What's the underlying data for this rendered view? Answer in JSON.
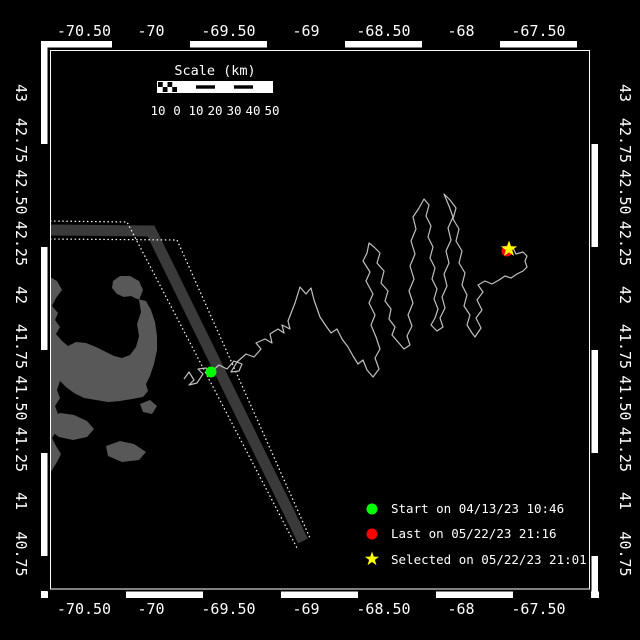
{
  "colors": {
    "background": "#000000",
    "land": "#585858",
    "track": "#c0c0c0",
    "lane_zone": "#3a3a3a",
    "frame": "#ffffff",
    "start_marker": "#00ff00",
    "last_marker": "#ff0000",
    "selected_marker": "#ffff00"
  },
  "axes": {
    "lon_labels": [
      "-70.50",
      "-70",
      "-69.50",
      "-69",
      "-68.50",
      "-68",
      "-67.50"
    ],
    "lat_labels": [
      "43",
      "42.75",
      "42.50",
      "42.25",
      "42",
      "41.75",
      "41.50",
      "41.25",
      "41",
      "40.75"
    ]
  },
  "scale_bar": {
    "title": "Scale (km)",
    "labels": [
      "10",
      "0",
      "10",
      "20",
      "30",
      "40",
      "50"
    ]
  },
  "legend": {
    "items": [
      {
        "marker": "green-circle",
        "label": "Start on 04/13/23 10:46"
      },
      {
        "marker": "red-circle",
        "label": "Last on 05/22/23 21:16"
      },
      {
        "marker": "yellow-star",
        "label": "Selected on 05/22/23 21:01"
      }
    ]
  },
  "markers": {
    "start": {
      "px": [
        211,
        372
      ],
      "lon": -69.61,
      "lat": 41.63
    },
    "last": {
      "px": [
        507,
        251
      ],
      "lon": -67.71,
      "lat": 42.21
    },
    "selected": {
      "px": [
        509,
        249
      ],
      "lon": -67.7,
      "lat": 42.22
    }
  },
  "lane": {
    "zone_center": [
      [
        50,
        230
      ],
      [
        151,
        231
      ],
      [
        303,
        541
      ]
    ],
    "west_boundary": [
      [
        50,
        221
      ],
      [
        127,
        222
      ],
      [
        297,
        548
      ]
    ],
    "east_boundary": [
      [
        50,
        239
      ],
      [
        177,
        240
      ],
      [
        310,
        538
      ]
    ]
  },
  "land": {
    "polygons": [
      {
        "name": "cape-cod-and-mainland",
        "points": [
          [
            50,
            277
          ],
          [
            57,
            281
          ],
          [
            62,
            290
          ],
          [
            56,
            298
          ],
          [
            52,
            306
          ],
          [
            58,
            313
          ],
          [
            55,
            320
          ],
          [
            60,
            327
          ],
          [
            56,
            334
          ],
          [
            62,
            341
          ],
          [
            68,
            346
          ],
          [
            76,
            342
          ],
          [
            86,
            343
          ],
          [
            96,
            347
          ],
          [
            106,
            352
          ],
          [
            114,
            356
          ],
          [
            122,
            358
          ],
          [
            130,
            355
          ],
          [
            136,
            347
          ],
          [
            139,
            336
          ],
          [
            137,
            324
          ],
          [
            141,
            312
          ],
          [
            139,
            300
          ],
          [
            143,
            290
          ],
          [
            139,
            281
          ],
          [
            130,
            276
          ],
          [
            120,
            276
          ],
          [
            113,
            281
          ],
          [
            112,
            288
          ],
          [
            117,
            294
          ],
          [
            124,
            297
          ],
          [
            131,
            296
          ],
          [
            137,
            299
          ],
          [
            146,
            301
          ],
          [
            151,
            310
          ],
          [
            155,
            322
          ],
          [
            157,
            336
          ],
          [
            157,
            350
          ],
          [
            154,
            364
          ],
          [
            150,
            376
          ],
          [
            146,
            384
          ],
          [
            148,
            391
          ],
          [
            143,
            397
          ],
          [
            132,
            399
          ],
          [
            120,
            401
          ],
          [
            108,
            402
          ],
          [
            96,
            400
          ],
          [
            84,
            398
          ],
          [
            74,
            393
          ],
          [
            66,
            387
          ],
          [
            60,
            381
          ],
          [
            57,
            390
          ],
          [
            60,
            398
          ],
          [
            55,
            406
          ],
          [
            58,
            414
          ],
          [
            63,
            422
          ],
          [
            57,
            430
          ],
          [
            52,
            438
          ],
          [
            56,
            446
          ],
          [
            61,
            454
          ],
          [
            57,
            462
          ],
          [
            52,
            470
          ],
          [
            50,
            472
          ]
        ]
      },
      {
        "name": "island-west",
        "points": [
          [
            50,
            418
          ],
          [
            60,
            413
          ],
          [
            74,
            415
          ],
          [
            87,
            421
          ],
          [
            94,
            429
          ],
          [
            87,
            437
          ],
          [
            73,
            440
          ],
          [
            59,
            437
          ],
          [
            51,
            431
          ]
        ]
      },
      {
        "name": "island-east",
        "points": [
          [
            106,
            446
          ],
          [
            120,
            441
          ],
          [
            134,
            444
          ],
          [
            146,
            452
          ],
          [
            139,
            460
          ],
          [
            122,
            462
          ],
          [
            108,
            456
          ]
        ]
      },
      {
        "name": "islet",
        "points": [
          [
            140,
            404
          ],
          [
            150,
            400
          ],
          [
            157,
            406
          ],
          [
            152,
            414
          ],
          [
            143,
            412
          ]
        ]
      }
    ]
  },
  "track": {
    "points_px": [
      [
        184,
        379
      ],
      [
        189,
        372
      ],
      [
        194,
        380
      ],
      [
        189,
        385
      ],
      [
        197,
        383
      ],
      [
        203,
        374
      ],
      [
        198,
        369
      ],
      [
        206,
        368
      ],
      [
        211,
        372
      ],
      [
        219,
        365
      ],
      [
        227,
        369
      ],
      [
        234,
        361
      ],
      [
        242,
        364
      ],
      [
        239,
        371
      ],
      [
        231,
        372
      ],
      [
        237,
        362
      ],
      [
        246,
        354
      ],
      [
        254,
        357
      ],
      [
        261,
        349
      ],
      [
        256,
        343
      ],
      [
        265,
        339
      ],
      [
        272,
        343
      ],
      [
        270,
        334
      ],
      [
        278,
        329
      ],
      [
        284,
        333
      ],
      [
        282,
        325
      ],
      [
        290,
        329
      ],
      [
        288,
        321
      ],
      [
        295,
        303
      ],
      [
        300,
        287
      ],
      [
        306,
        294
      ],
      [
        311,
        288
      ],
      [
        314,
        300
      ],
      [
        320,
        317
      ],
      [
        326,
        326
      ],
      [
        331,
        333
      ],
      [
        337,
        329
      ],
      [
        342,
        339
      ],
      [
        348,
        347
      ],
      [
        353,
        356
      ],
      [
        358,
        364
      ],
      [
        363,
        360
      ],
      [
        367,
        370
      ],
      [
        373,
        377
      ],
      [
        379,
        369
      ],
      [
        375,
        358
      ],
      [
        380,
        349
      ],
      [
        376,
        337
      ],
      [
        371,
        325
      ],
      [
        375,
        315
      ],
      [
        369,
        303
      ],
      [
        373,
        294
      ],
      [
        366,
        281
      ],
      [
        370,
        272
      ],
      [
        363,
        261
      ],
      [
        367,
        253
      ],
      [
        369,
        243
      ],
      [
        374,
        247
      ],
      [
        380,
        253
      ],
      [
        377,
        263
      ],
      [
        384,
        271
      ],
      [
        381,
        283
      ],
      [
        388,
        291
      ],
      [
        385,
        301
      ],
      [
        391,
        309
      ],
      [
        389,
        319
      ],
      [
        395,
        327
      ],
      [
        392,
        335
      ],
      [
        398,
        342
      ],
      [
        404,
        349
      ],
      [
        410,
        345
      ],
      [
        407,
        336
      ],
      [
        412,
        326
      ],
      [
        408,
        315
      ],
      [
        413,
        303
      ],
      [
        409,
        291
      ],
      [
        414,
        279
      ],
      [
        410,
        266
      ],
      [
        415,
        254
      ],
      [
        411,
        241
      ],
      [
        416,
        229
      ],
      [
        413,
        217
      ],
      [
        419,
        208
      ],
      [
        424,
        199
      ],
      [
        429,
        205
      ],
      [
        426,
        216
      ],
      [
        431,
        226
      ],
      [
        428,
        237
      ],
      [
        433,
        247
      ],
      [
        430,
        258
      ],
      [
        435,
        268
      ],
      [
        432,
        279
      ],
      [
        437,
        289
      ],
      [
        434,
        299
      ],
      [
        438,
        309
      ],
      [
        435,
        318
      ],
      [
        431,
        325
      ],
      [
        437,
        331
      ],
      [
        443,
        327
      ],
      [
        440,
        318
      ],
      [
        445,
        308
      ],
      [
        442,
        297
      ],
      [
        447,
        286
      ],
      [
        444,
        274
      ],
      [
        449,
        263
      ],
      [
        446,
        251
      ],
      [
        451,
        240
      ],
      [
        448,
        228
      ],
      [
        453,
        217
      ],
      [
        449,
        206
      ],
      [
        444,
        194
      ],
      [
        450,
        200
      ],
      [
        456,
        208
      ],
      [
        453,
        219
      ],
      [
        459,
        229
      ],
      [
        456,
        241
      ],
      [
        462,
        251
      ],
      [
        459,
        263
      ],
      [
        465,
        273
      ],
      [
        462,
        285
      ],
      [
        467,
        295
      ],
      [
        464,
        306
      ],
      [
        470,
        315
      ],
      [
        467,
        325
      ],
      [
        472,
        333
      ],
      [
        475,
        337
      ],
      [
        481,
        328
      ],
      [
        476,
        318
      ],
      [
        482,
        310
      ],
      [
        477,
        300
      ],
      [
        483,
        292
      ],
      [
        478,
        285
      ],
      [
        485,
        281
      ],
      [
        492,
        284
      ],
      [
        499,
        280
      ],
      [
        505,
        276
      ],
      [
        511,
        278
      ],
      [
        517,
        274
      ],
      [
        523,
        271
      ],
      [
        527,
        267
      ],
      [
        525,
        261
      ],
      [
        527,
        256
      ],
      [
        523,
        252
      ],
      [
        516,
        254
      ],
      [
        513,
        248
      ],
      [
        509,
        249
      ]
    ]
  },
  "chart_data": {
    "type": "line",
    "title": "",
    "xlabel": "longitude (deg)",
    "ylabel": "latitude (deg)",
    "xlim": [
      -70.66,
      -67.16
    ],
    "ylim": [
      40.57,
      43.19
    ],
    "x_ticks": [
      -70.5,
      -70,
      -69.5,
      -69,
      -68.5,
      -68,
      -67.5
    ],
    "y_ticks": [
      43,
      42.75,
      42.5,
      42.25,
      42,
      41.75,
      41.5,
      41.25,
      41,
      40.75
    ],
    "grid": false,
    "legend_position": "bottom-right",
    "series": [
      {
        "name": "glider-track",
        "summary": "wiggly track from start point (-69.61,41.63) eastward across a traffic separation lane, four elongated NE-SW survey loops between -69.6 and -67.9, ending near (-67.70,42.22)"
      }
    ],
    "points": [
      {
        "name": "Start",
        "lon": -69.61,
        "lat": 41.63,
        "time": "04/13/23 10:46"
      },
      {
        "name": "Last",
        "lon": -67.71,
        "lat": 42.21,
        "time": "05/22/23 21:16"
      },
      {
        "name": "Selected",
        "lon": -67.7,
        "lat": 42.22,
        "time": "05/22/23 21:01"
      }
    ]
  }
}
